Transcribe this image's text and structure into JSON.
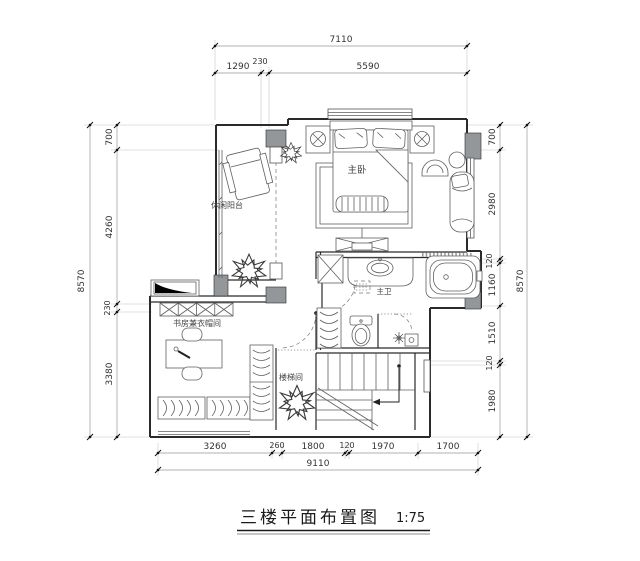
{
  "title": {
    "text": "三楼平面布置图",
    "scale": "1:75"
  },
  "rooms": {
    "master_bedroom": "主卧",
    "leisure_balcony": "休闲阳台",
    "study_cloakroom": "书房兼衣帽间",
    "master_bath": "主卫",
    "stairwell": "楼梯间"
  },
  "dimensions": {
    "top": {
      "total": "7110",
      "segments": [
        "1290",
        "230",
        "5590"
      ]
    },
    "left": {
      "total": "8570",
      "segments": [
        "700",
        "4260",
        "230",
        "3380"
      ]
    },
    "right": {
      "total": "8570",
      "segments": [
        "700",
        "2980",
        "120",
        "1160",
        "1510",
        "120",
        "1980"
      ]
    },
    "bottom": {
      "total": "9110",
      "segments": [
        "3260",
        "260",
        "1800",
        "120",
        "1970",
        "1700"
      ]
    }
  },
  "colors": {
    "wall": "#2a2a2a",
    "poche": "#939799",
    "furniture": "#606060",
    "dim_text": "#333333"
  }
}
